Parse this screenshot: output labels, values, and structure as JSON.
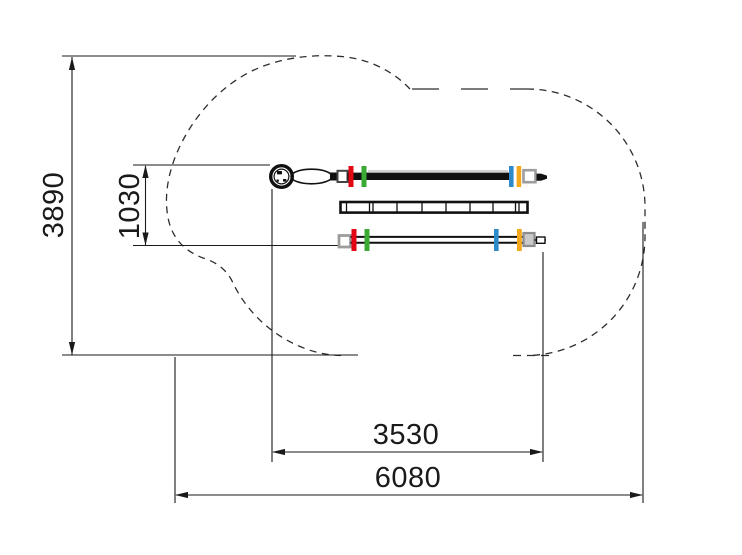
{
  "drawing": {
    "dimensions": {
      "depth": "3890",
      "line_spacing": "1030",
      "span": "3530",
      "width": "6080"
    },
    "colors": {
      "red": "#e30613",
      "green": "#3aaa35",
      "blue": "#2e8bc9",
      "yellow": "#f6a81c",
      "gray": "#9d9d9c",
      "ink": "#1a1a1a"
    }
  }
}
